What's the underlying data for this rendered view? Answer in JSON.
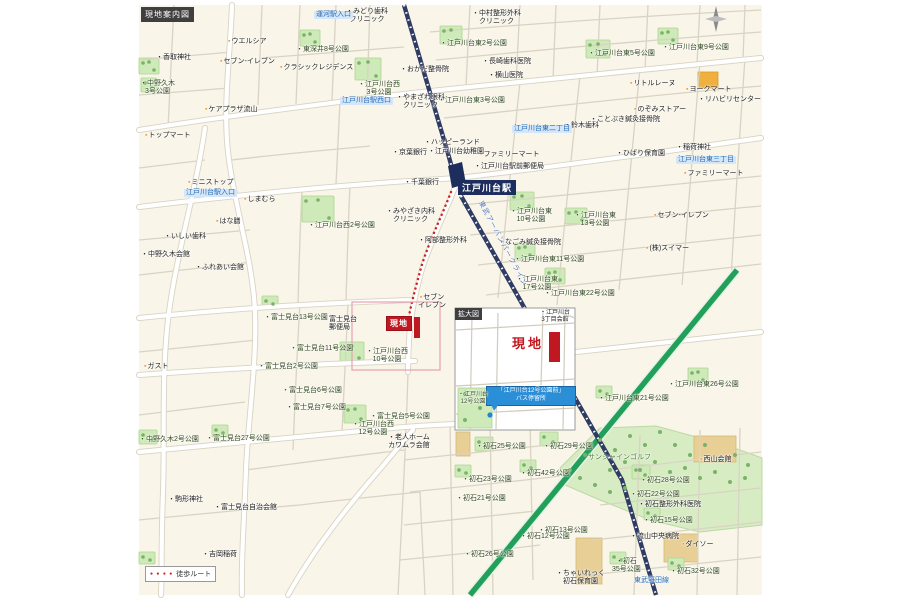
{
  "header": {
    "title": "現地案内図"
  },
  "legend": {
    "dots": "● ● ● ●",
    "walk_route": "徒歩ルート"
  },
  "station": {
    "name": "江戸川台駅",
    "line_name": "東武アーバンパークライン",
    "line_name_short": "東武野田線"
  },
  "site": {
    "label": "現地"
  },
  "inset": {
    "title": "拡大図",
    "site_label": "現地",
    "bus_stop_line1": "「江戸川台12号公園前」",
    "bus_stop_line2": "バス停留所"
  },
  "colors": {
    "site_red": "#c01820",
    "route_red": "#d02020",
    "rail_navy": "#2e3b63",
    "road_green": "#22a05a",
    "park_green": "#cdeab8",
    "label_blue": "#2a6db5",
    "callout_blue": "#2b8fd8",
    "map_cream": "#f9f5e9"
  },
  "map_labels": [
    {
      "t": "ウエルシア",
      "x": 228,
      "y": 38,
      "c": "shop"
    },
    {
      "t": "セブン-イレブン",
      "x": 220,
      "y": 58,
      "c": "shop"
    },
    {
      "t": "クラシックレジデンス",
      "x": 280,
      "y": 64,
      "c": "shop"
    },
    {
      "t": "ケアプラザ流山",
      "x": 205,
      "y": 106,
      "c": "shop"
    },
    {
      "t": "トップマート",
      "x": 145,
      "y": 132,
      "c": "shop"
    },
    {
      "t": "ミニストップ",
      "x": 188,
      "y": 179,
      "c": "shop"
    },
    {
      "t": "しまむら",
      "x": 244,
      "y": 196,
      "c": "shop"
    },
    {
      "t": "はな膳",
      "x": 216,
      "y": 218,
      "c": "shop"
    },
    {
      "t": "ヨークマート",
      "x": 686,
      "y": 86,
      "c": "shop"
    },
    {
      "t": "リトルレーヌ",
      "x": 630,
      "y": 80,
      "c": "shop"
    },
    {
      "t": "のぞみストアー",
      "x": 634,
      "y": 106,
      "c": "shop"
    },
    {
      "t": "ファミリーマート",
      "x": 480,
      "y": 151,
      "c": "shop"
    },
    {
      "t": "ファミリーマート",
      "x": 684,
      "y": 170,
      "c": "shop"
    },
    {
      "t": "セブン-イレブン",
      "x": 654,
      "y": 212,
      "c": "shop"
    },
    {
      "t": "セブン\nイレブン",
      "x": 418,
      "y": 294,
      "c": "shop"
    },
    {
      "t": "ガスト",
      "x": 144,
      "y": 363,
      "c": "shop"
    },
    {
      "t": "ダイソー",
      "x": 682,
      "y": 541,
      "c": "shop"
    },
    {
      "t": "(株)スイマー",
      "x": 646,
      "y": 245,
      "c": "shop"
    },
    {
      "t": "西山会館",
      "x": 700,
      "y": 456,
      "c": "shop"
    },
    {
      "t": "みどり歯科\nクリニック",
      "x": 346,
      "y": 8,
      "c": "poi"
    },
    {
      "t": "中村整形外科\nクリニック",
      "x": 472,
      "y": 10,
      "c": "poi"
    },
    {
      "t": "香取神社",
      "x": 156,
      "y": 54,
      "c": "poi"
    },
    {
      "t": "長崎歯科医院",
      "x": 482,
      "y": 58,
      "c": "poi"
    },
    {
      "t": "横山医院",
      "x": 488,
      "y": 72,
      "c": "poi"
    },
    {
      "t": "おかだ整骨院",
      "x": 400,
      "y": 66,
      "c": "poi"
    },
    {
      "t": "やまざわ眼科\nクリニック",
      "x": 396,
      "y": 94,
      "c": "poi"
    },
    {
      "t": "ことぶき鍼灸接骨院",
      "x": 590,
      "y": 116,
      "c": "poi"
    },
    {
      "t": "鈴木歯科",
      "x": 564,
      "y": 122,
      "c": "poi"
    },
    {
      "t": "リハビリセンター",
      "x": 698,
      "y": 96,
      "c": "poi"
    },
    {
      "t": "京葉銀行",
      "x": 392,
      "y": 149,
      "c": "poi"
    },
    {
      "t": "千葉銀行",
      "x": 404,
      "y": 179,
      "c": "poi"
    },
    {
      "t": "ハッピーランド",
      "x": 424,
      "y": 139,
      "c": "poi"
    },
    {
      "t": "江戸川台幼稚園",
      "x": 428,
      "y": 148,
      "c": "poi"
    },
    {
      "t": "江戸川台駅前郵便局",
      "x": 474,
      "y": 163,
      "c": "poi"
    },
    {
      "t": "ひばり保育園",
      "x": 616,
      "y": 150,
      "c": "poi"
    },
    {
      "t": "稲荷神社",
      "x": 676,
      "y": 144,
      "c": "poi"
    },
    {
      "t": "みやざき内科\nクリニック",
      "x": 386,
      "y": 208,
      "c": "poi"
    },
    {
      "t": "阿部整形外科",
      "x": 418,
      "y": 237,
      "c": "poi"
    },
    {
      "t": "なごみ鍼灸接骨院",
      "x": 498,
      "y": 239,
      "c": "poi"
    },
    {
      "t": "いしい歯科",
      "x": 164,
      "y": 233,
      "c": "poi"
    },
    {
      "t": "中野久木会館",
      "x": 141,
      "y": 251,
      "c": "poi"
    },
    {
      "t": "ふれあい会館",
      "x": 195,
      "y": 264,
      "c": "poi"
    },
    {
      "t": "富士見台\n郵便局",
      "x": 322,
      "y": 316,
      "c": "poi"
    },
    {
      "t": "老人ホーム\nカワムラ会館",
      "x": 388,
      "y": 434,
      "c": "poi"
    },
    {
      "t": "初石整形外科医院",
      "x": 638,
      "y": 501,
      "c": "poi"
    },
    {
      "t": "流山中央病院",
      "x": 630,
      "y": 533,
      "c": "poi"
    },
    {
      "t": "駒形神社",
      "x": 168,
      "y": 496,
      "c": "poi"
    },
    {
      "t": "富士見台自治会館",
      "x": 214,
      "y": 504,
      "c": "poi"
    },
    {
      "t": "吉岡稲荷",
      "x": 202,
      "y": 551,
      "c": "poi"
    },
    {
      "t": "ちゃいれっく\n初石保育園",
      "x": 556,
      "y": 570,
      "c": "poi"
    },
    {
      "t": "東深井8号公園",
      "x": 296,
      "y": 46,
      "c": "park"
    },
    {
      "t": "中野久木\n3号公園",
      "x": 140,
      "y": 80,
      "c": "park"
    },
    {
      "t": "江戸川台東2号公園",
      "x": 440,
      "y": 40,
      "c": "park"
    },
    {
      "t": "江戸川台西\n3号公園",
      "x": 358,
      "y": 81,
      "c": "park"
    },
    {
      "t": "江戸川台東3号公園",
      "x": 438,
      "y": 97,
      "c": "park"
    },
    {
      "t": "江戸川台東5号公園",
      "x": 588,
      "y": 50,
      "c": "park"
    },
    {
      "t": "江戸川台東9号公園",
      "x": 662,
      "y": 44,
      "c": "park"
    },
    {
      "t": "江戸川台西2号公園",
      "x": 308,
      "y": 222,
      "c": "park"
    },
    {
      "t": "江戸川台東\n10号公園",
      "x": 510,
      "y": 208,
      "c": "park"
    },
    {
      "t": "江戸川台東\n13号公園",
      "x": 574,
      "y": 212,
      "c": "park"
    },
    {
      "t": "江戸川台東11号公園",
      "x": 514,
      "y": 256,
      "c": "park"
    },
    {
      "t": "江戸川台東\n17号公園",
      "x": 516,
      "y": 276,
      "c": "park"
    },
    {
      "t": "江戸川台東22号公園",
      "x": 544,
      "y": 290,
      "c": "park"
    },
    {
      "t": "江戸川台東21号公園",
      "x": 598,
      "y": 395,
      "c": "park"
    },
    {
      "t": "江戸川台東26号公園",
      "x": 668,
      "y": 381,
      "c": "park"
    },
    {
      "t": "富士見台13号公園",
      "x": 264,
      "y": 314,
      "c": "park"
    },
    {
      "t": "富士見台11号公園",
      "x": 290,
      "y": 345,
      "c": "park"
    },
    {
      "t": "富士見台2号公園",
      "x": 258,
      "y": 363,
      "c": "park"
    },
    {
      "t": "富士見台6号公園",
      "x": 282,
      "y": 387,
      "c": "park"
    },
    {
      "t": "富士見台7号公園",
      "x": 286,
      "y": 404,
      "c": "park"
    },
    {
      "t": "富士見台5号公園",
      "x": 370,
      "y": 413,
      "c": "park"
    },
    {
      "t": "江戸川台西\n10号公園",
      "x": 366,
      "y": 348,
      "c": "park"
    },
    {
      "t": "江戸川台西\n12号公園",
      "x": 352,
      "y": 421,
      "c": "park"
    },
    {
      "t": "富士見台27号公園",
      "x": 206,
      "y": 435,
      "c": "park"
    },
    {
      "t": "中野久木2号公園",
      "x": 139,
      "y": 436,
      "c": "park"
    },
    {
      "t": "初石25号公園",
      "x": 476,
      "y": 443,
      "c": "park"
    },
    {
      "t": "初石23号公園",
      "x": 462,
      "y": 476,
      "c": "park"
    },
    {
      "t": "初石21号公園",
      "x": 456,
      "y": 495,
      "c": "park"
    },
    {
      "t": "初石42号公園",
      "x": 520,
      "y": 470,
      "c": "park"
    },
    {
      "t": "初石12号公園",
      "x": 520,
      "y": 533,
      "c": "park"
    },
    {
      "t": "初石26号公園",
      "x": 464,
      "y": 551,
      "c": "park"
    },
    {
      "t": "初石29号公園",
      "x": 543,
      "y": 443,
      "c": "park"
    },
    {
      "t": "初石28号公園",
      "x": 640,
      "y": 477,
      "c": "park"
    },
    {
      "t": "初石22号公園",
      "x": 630,
      "y": 491,
      "c": "park"
    },
    {
      "t": "初石15号公園",
      "x": 643,
      "y": 517,
      "c": "park"
    },
    {
      "t": "初石32号公園",
      "x": 670,
      "y": 568,
      "c": "park"
    },
    {
      "t": "初石\n35号公園",
      "x": 612,
      "y": 558,
      "c": "park"
    },
    {
      "t": "初石13号公園",
      "x": 538,
      "y": 527,
      "c": "park"
    },
    {
      "t": "サンシャインゴルフ",
      "x": 588,
      "y": 454,
      "c": "area"
    },
    {
      "t": "運河駅入口",
      "x": 314,
      "y": 11,
      "c": "road"
    },
    {
      "t": "江戸川台駅西口",
      "x": 340,
      "y": 97,
      "c": "road"
    },
    {
      "t": "江戸川台駅入口",
      "x": 184,
      "y": 189,
      "c": "road"
    },
    {
      "t": "江戸川台東二丁目",
      "x": 512,
      "y": 125,
      "c": "road"
    },
    {
      "t": "江戸川台東三丁目",
      "x": 676,
      "y": 156,
      "c": "road"
    },
    {
      "t": "東武野田線",
      "x": 634,
      "y": 577,
      "c": "bluetext"
    },
    {
      "t": "東武アーバンパークライン",
      "x": 483,
      "y": 200,
      "c": "railtext"
    },
    {
      "t": "江戸川台\n3丁目会館",
      "x": 540,
      "y": 310,
      "c": "poi tiny"
    },
    {
      "t": "江戸川台\n12号公園",
      "x": 458,
      "y": 392,
      "c": "park tiny"
    }
  ]
}
